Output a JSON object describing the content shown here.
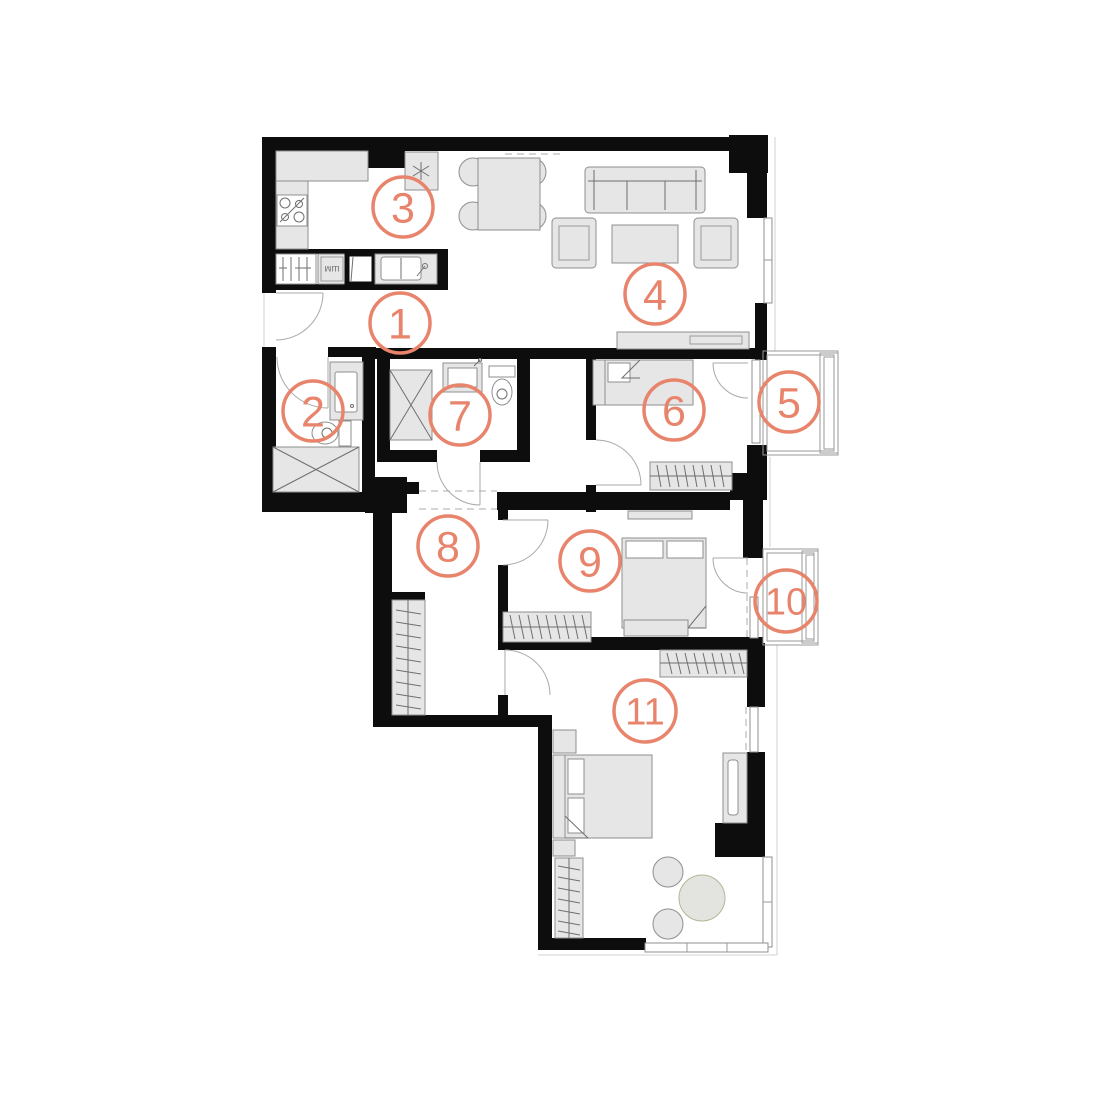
{
  "plan": {
    "title": "apartment-floor-plan",
    "canvas": {
      "width": 1100,
      "height": 1100,
      "background": "#ffffff"
    }
  },
  "colors": {
    "accent": "#E8846B",
    "wall": "#0D0D0D",
    "furniture_fill": "#E6E6E6",
    "furniture_stroke": "#8F8F8F",
    "line": "#9A9A9A"
  },
  "labels": {
    "washer": "шм"
  },
  "rooms": [
    {
      "id": "room-1",
      "label": "1",
      "cx": 400,
      "cy": 323,
      "r": 30
    },
    {
      "id": "room-2",
      "label": "2",
      "cx": 313,
      "cy": 411,
      "r": 30
    },
    {
      "id": "room-3",
      "label": "3",
      "cx": 403,
      "cy": 207,
      "r": 30
    },
    {
      "id": "room-4",
      "label": "4",
      "cx": 655,
      "cy": 294,
      "r": 30
    },
    {
      "id": "room-5",
      "label": "5",
      "cx": 789,
      "cy": 402,
      "r": 30
    },
    {
      "id": "room-6",
      "label": "6",
      "cx": 674,
      "cy": 410,
      "r": 30
    },
    {
      "id": "room-7",
      "label": "7",
      "cx": 460,
      "cy": 415,
      "r": 30
    },
    {
      "id": "room-8",
      "label": "8",
      "cx": 448,
      "cy": 546,
      "r": 30
    },
    {
      "id": "room-9",
      "label": "9",
      "cx": 590,
      "cy": 561,
      "r": 30
    },
    {
      "id": "room-10",
      "label": "10",
      "cx": 786,
      "cy": 601,
      "r": 31
    },
    {
      "id": "room-11",
      "label": "11",
      "cx": 645,
      "cy": 711,
      "r": 31
    }
  ]
}
